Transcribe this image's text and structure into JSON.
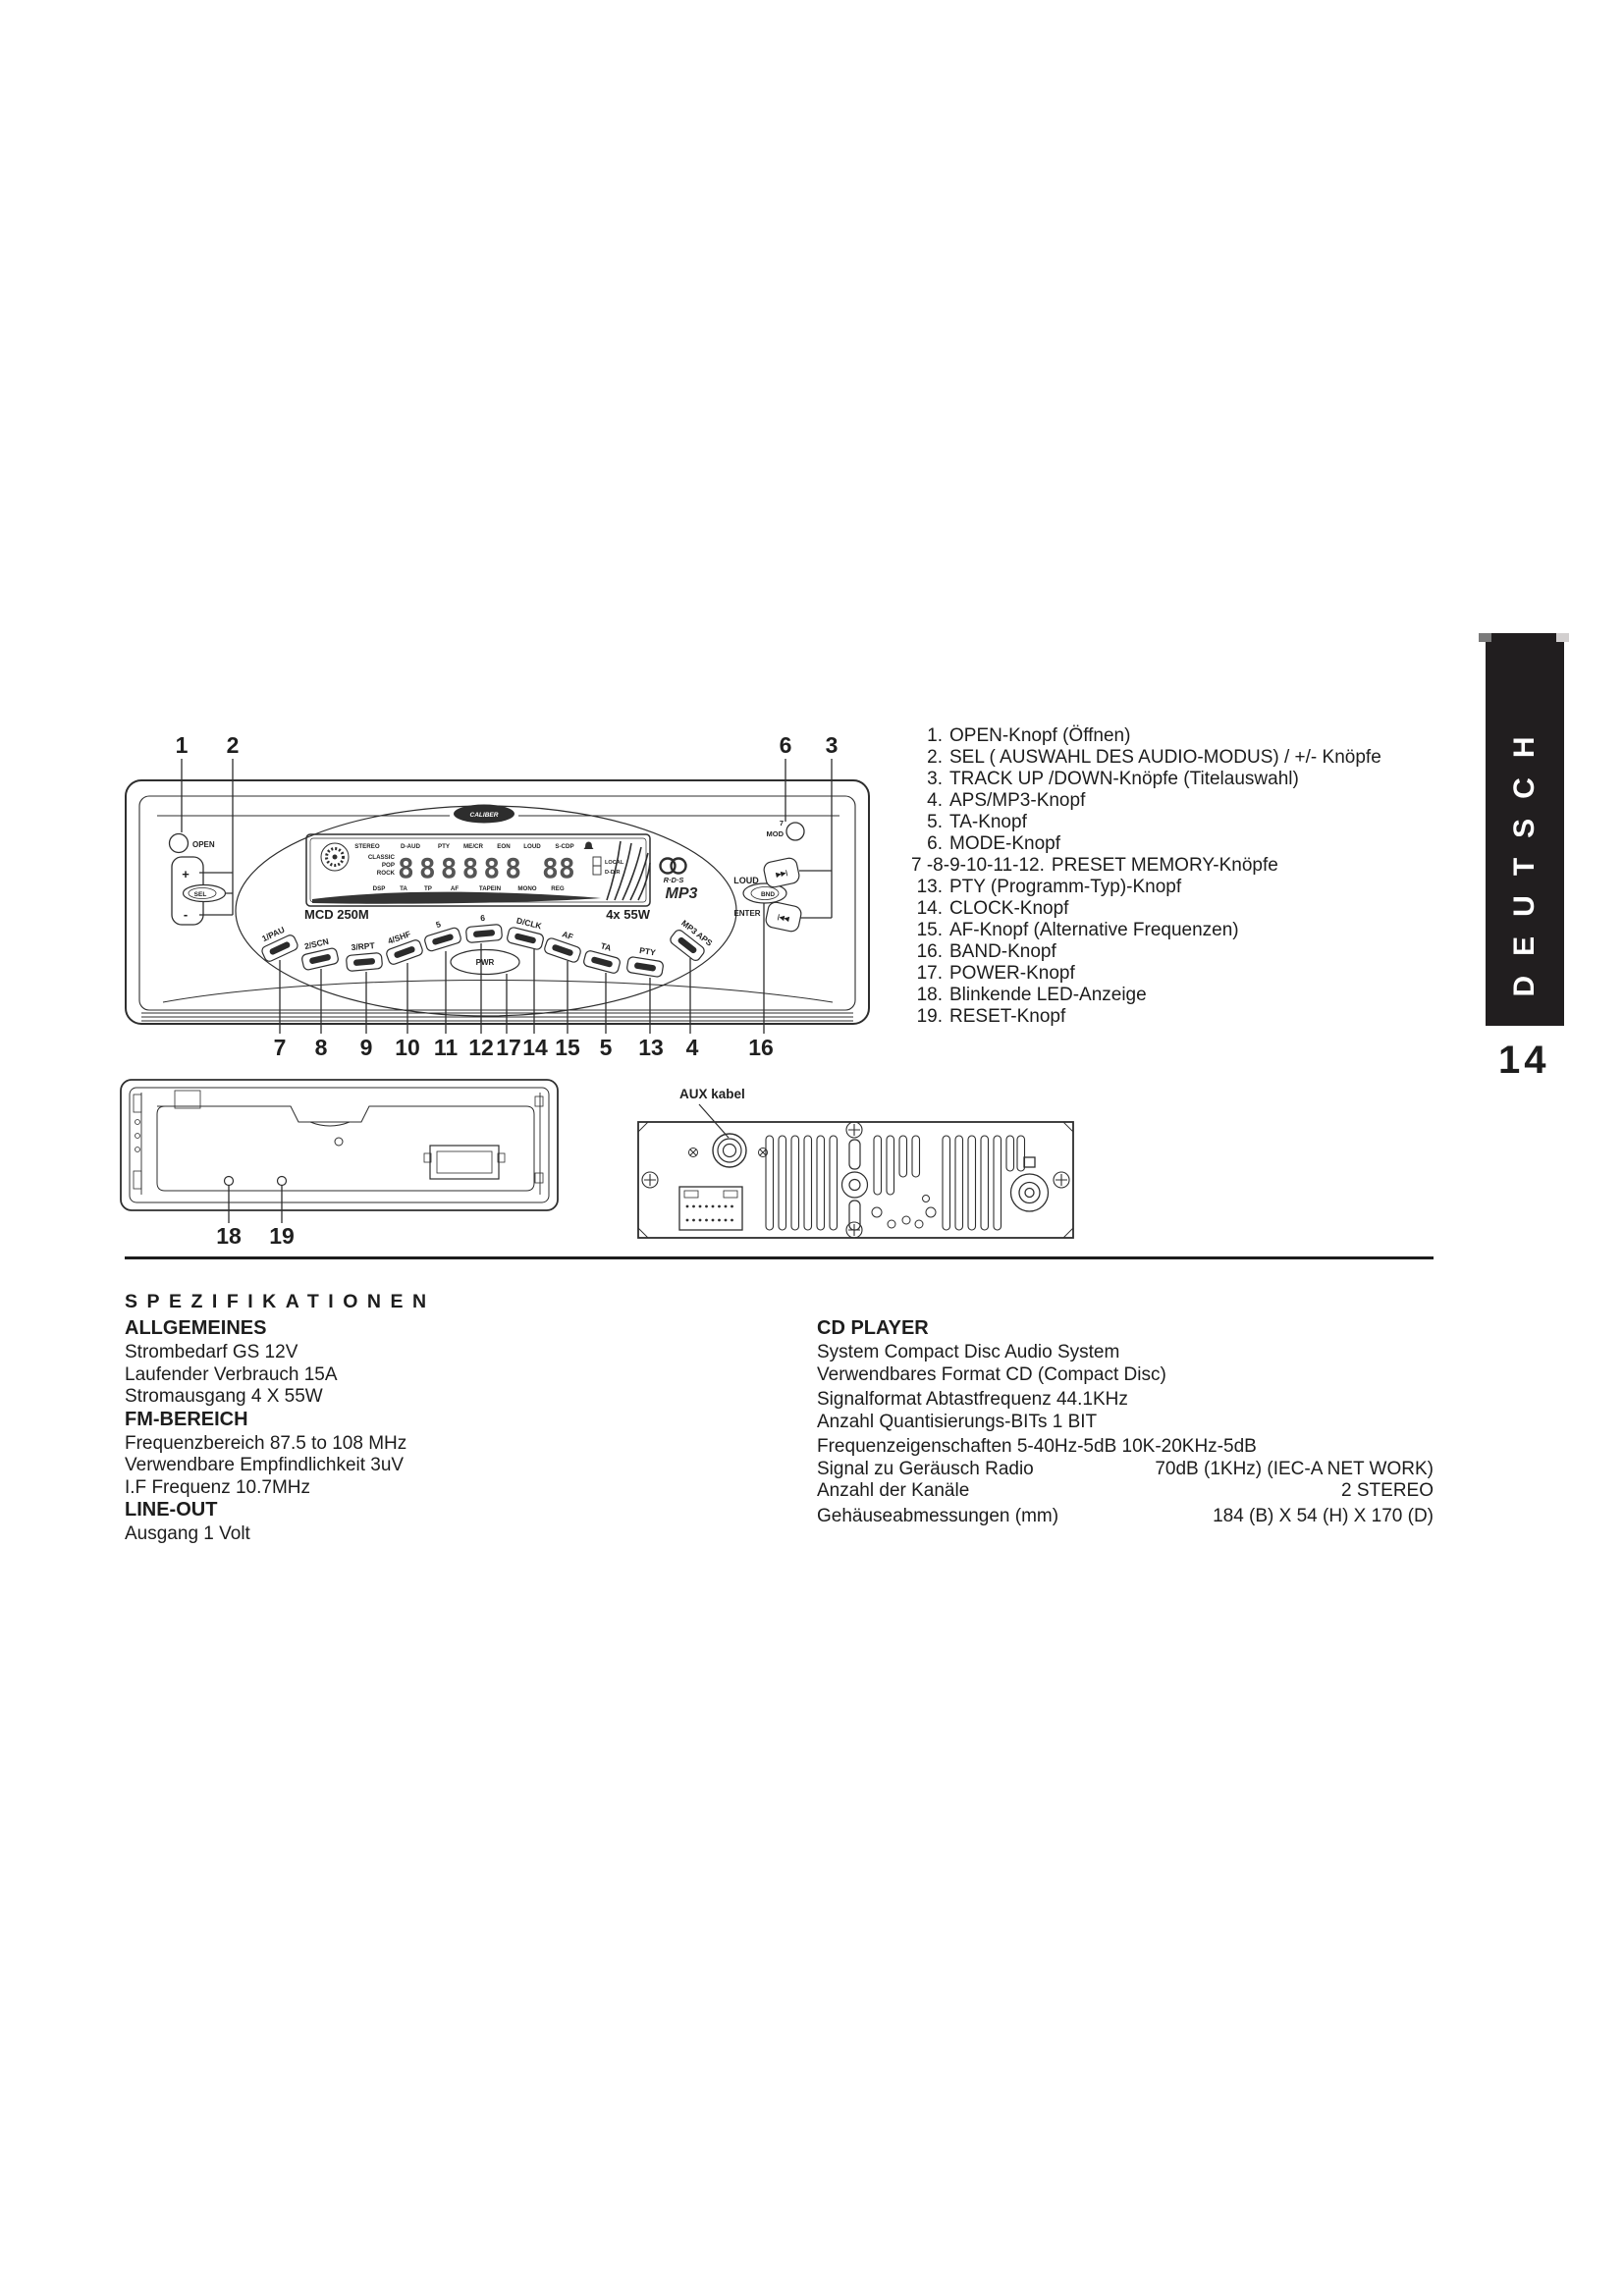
{
  "page": {
    "number": "14",
    "tab": "DEUTSCH"
  },
  "callouts": {
    "items": [
      {
        "num": "1.",
        "label": "OPEN-Knopf (Öffnen)"
      },
      {
        "num": "2.",
        "label": "SEL ( AUSWAHL DES AUDIO-MODUS) / +/- Knöpfe"
      },
      {
        "num": "3.",
        "label": "TRACK UP /DOWN-Knöpfe (Titelauswahl)"
      },
      {
        "num": "4.",
        "label": "APS/MP3-Knopf"
      },
      {
        "num": "5.",
        "label": "TA-Knopf"
      },
      {
        "num": "6.",
        "label": "MODE-Knopf"
      },
      {
        "num": "7 -8-9-10-11-12.",
        "label": "PRESET MEMORY-Knöpfe"
      },
      {
        "num": "13.",
        "label": "PTY (Programm-Typ)-Knopf"
      },
      {
        "num": "14.",
        "label": "CLOCK-Knopf"
      },
      {
        "num": "15.",
        "label": "AF-Knopf  (Alternative Frequenzen)"
      },
      {
        "num": "16.",
        "label": "BAND-Knopf"
      },
      {
        "num": "17.",
        "label": "POWER-Knopf"
      },
      {
        "num": "18.",
        "label": "Blinkende LED-Anzeige"
      },
      {
        "num": "19.",
        "label": "RESET-Knopf"
      }
    ]
  },
  "front_panel": {
    "top_nums": [
      "1",
      "2",
      "6",
      "3"
    ],
    "bottom_nums": [
      "7",
      "8",
      "9",
      "10",
      "11",
      "12",
      "17",
      "14",
      "15",
      "5",
      "13",
      "4",
      "16"
    ],
    "open": "OPEN",
    "mod_num": "7",
    "mod": "MOD",
    "brand": "CALIBER",
    "plus": "+",
    "sel": "SEL",
    "minus": "-",
    "model": "MCD 250M",
    "power": "4x 55W",
    "display": {
      "top": [
        "STEREO",
        "D-AUD",
        "PTY",
        "ME/CR",
        "EON",
        "LOUD",
        "S-CDP"
      ],
      "genres": [
        "CLASSIC",
        "POP",
        "ROCK"
      ],
      "digits_main": "888888",
      "digits_sub": "88",
      "right": [
        "LOCAL",
        "D-DIR"
      ],
      "bottom": [
        "DSP",
        "TA",
        "TP",
        "AF",
        "TAPEIN",
        "MONO",
        "REG"
      ]
    },
    "rds": "R·D·S",
    "mp3": "MP3",
    "loud": "LOUD",
    "bnd": "BND",
    "enter": "ENTER",
    "ff": "▶▶|",
    "rew": "|◀◀",
    "buttons": [
      "1/PAU",
      "2/SCN",
      "3/RPT",
      "4/SHF",
      "5",
      "6",
      "D/CLK",
      "AF",
      "TA",
      "PTY",
      "MP3 APS"
    ],
    "pwr": "PWR"
  },
  "chassis": {
    "nums": [
      "18",
      "19"
    ]
  },
  "rear": {
    "aux": "AUX kabel"
  },
  "specs": {
    "title": "SPEZIFIKATIONEN",
    "general_heading": "ALLGEMEINES",
    "general": [
      "Strombedarf GS 12V",
      "Laufender Verbrauch 15A",
      "Stromausgang 4 X 55W"
    ],
    "fm_heading": "FM-BEREICH",
    "fm": [
      "Frequenzbereich 87.5 to 108 MHz",
      "Verwendbare Empfindlichkeit 3uV",
      "I.F Frequenz 10.7MHz"
    ],
    "lineout_heading": "LINE-OUT",
    "lineout": [
      "Ausgang 1 Volt"
    ],
    "cd_heading": "CD PLAYER",
    "cd": [
      {
        "label": "System Compact Disc Audio System",
        "value": ""
      },
      {
        "label": "Verwendbares Format CD (Compact Disc)",
        "value": ""
      },
      {
        "label": "Signalformat Abtastfrequenz 44.1KHz",
        "value": ""
      },
      {
        "label": "Anzahl Quantisierungs-BITs 1 BIT",
        "value": ""
      },
      {
        "label": "Frequenzeigenschaften 5-40Hz-5dB 10K-20KHz-5dB",
        "value": ""
      },
      {
        "label": "Signal zu Geräusch Radio",
        "value": "70dB (1KHz) (IEC-A NET WORK)"
      },
      {
        "label": "Anzahl der Kanäle",
        "value": "2 STEREO"
      },
      {
        "label": "Gehäuseabmessungen (mm)",
        "value": "184 (B) X 54 (H) X 170 (D)"
      }
    ]
  }
}
